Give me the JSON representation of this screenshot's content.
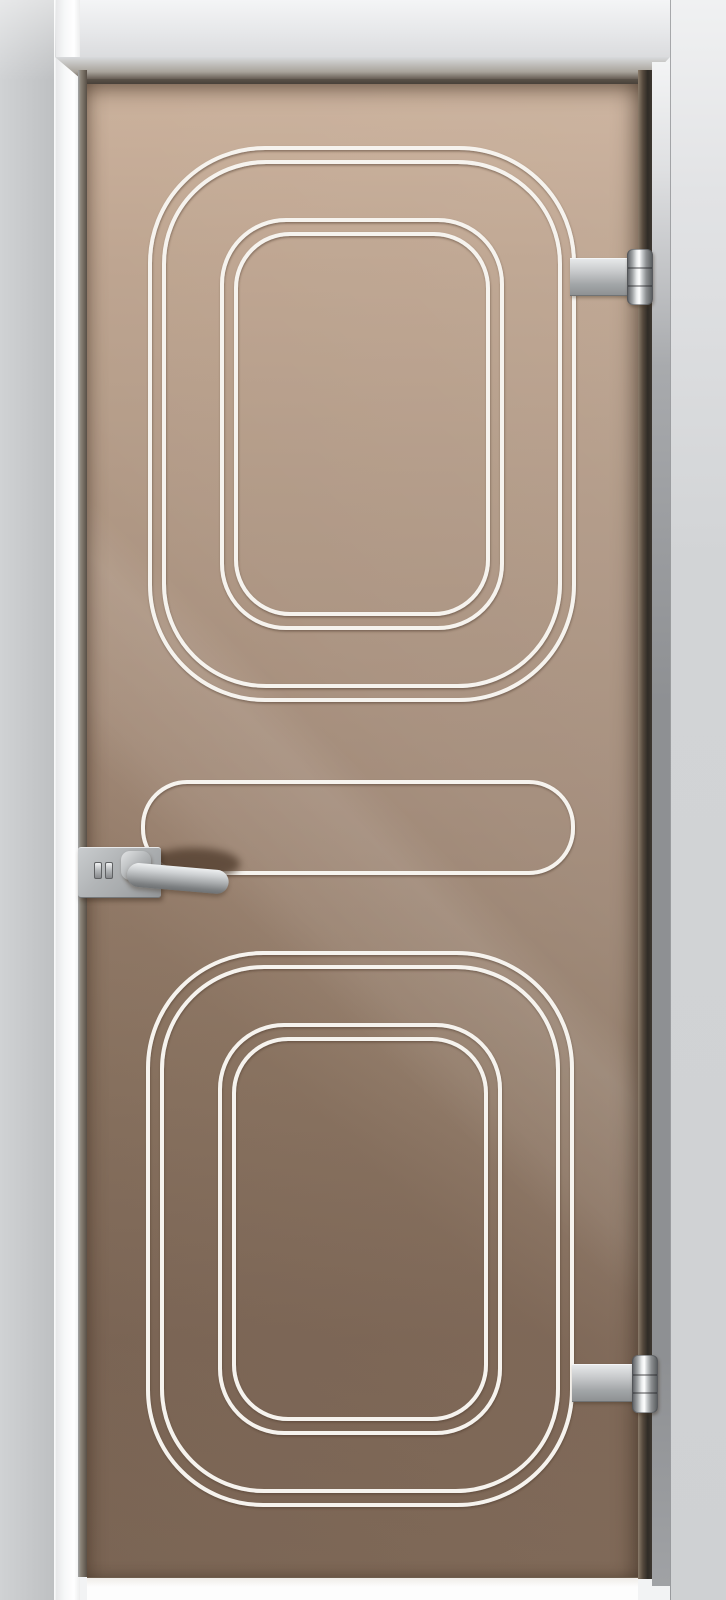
{
  "canvas": {
    "w": 726,
    "h": 1600
  },
  "palette": {
    "backdrop": "#f2f3f4",
    "floor": "#fdfdfd",
    "casing_left": "#c6c8ca",
    "header_bottom": "#dbdcde",
    "bevel_light": "#d8dadc",
    "bevel_dark": "#4a443c",
    "rebate_dark": "#584f46",
    "glass_top": "#c4a78f",
    "glass_upper": "#a98f7a",
    "glass_lower": "#846d5c",
    "glass_bottom": "#87705e",
    "glass_edge_dark": "#3e3831",
    "jamb_right_top": "#f3f4f5",
    "jamb_right_mid": "#8e9093",
    "casing_right_top": "#f0f1f2",
    "casing_right": "#d2d4d6",
    "etch_line": "#f6f3ee",
    "etch_shadow": "#4a3626",
    "metal_mid": "#aaadaf",
    "metal_dark": "#6e7173",
    "handle_shadow": "#4e3a2b"
  },
  "door": {
    "glass": {
      "x": 87,
      "y": 84,
      "w": 551,
      "h": 1493
    },
    "pattern": {
      "stroke_width": 4,
      "motifs": [
        {
          "name": "top-motif",
          "x": 150,
          "y": 148,
          "w": 424,
          "h": 552,
          "rings": [
            {
              "inset": 0,
              "r": 115
            },
            {
              "inset": 14,
              "r": 102
            },
            {
              "inset": 72,
              "r": 64
            },
            {
              "inset": 86,
              "r": 54
            }
          ]
        },
        {
          "name": "middle-band",
          "x": 143,
          "y": 782,
          "w": 430,
          "h": 91,
          "rings": [
            {
              "inset": 0,
              "r": 44
            }
          ]
        },
        {
          "name": "bottom-motif",
          "x": 148,
          "y": 953,
          "w": 424,
          "h": 552,
          "rings": [
            {
              "inset": 0,
              "r": 115
            },
            {
              "inset": 14,
              "r": 102
            },
            {
              "inset": 72,
              "r": 64
            },
            {
              "inset": 86,
              "r": 54
            }
          ]
        }
      ]
    },
    "handle": {
      "shadow": {
        "x": 148,
        "y": 848,
        "w": 92,
        "h": 32
      },
      "plate": {
        "x": 78,
        "y": 847,
        "w": 83,
        "h": 51
      },
      "lock": {
        "x": 94,
        "y": 861,
        "w": 22,
        "h": 19
      },
      "bend": {
        "x": 121,
        "y": 851,
        "w": 30,
        "h": 29
      },
      "grip": {
        "x": 127,
        "y": 862,
        "w": 102,
        "h": 24,
        "angle": 5
      }
    },
    "hinges": [
      {
        "name": "top",
        "plate": {
          "x": 570,
          "y": 258,
          "w": 59,
          "h": 38
        },
        "barrel": {
          "x": 627,
          "y": 249,
          "w": 26,
          "h": 56
        }
      },
      {
        "name": "bottom",
        "plate": {
          "x": 572,
          "y": 1364,
          "w": 62,
          "h": 38
        },
        "barrel": {
          "x": 632,
          "y": 1355,
          "w": 26,
          "h": 58
        }
      }
    ]
  }
}
